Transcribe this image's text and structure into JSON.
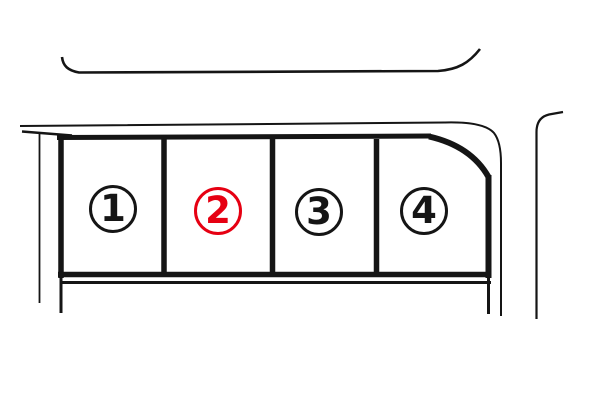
{
  "diagram": {
    "type": "lot-map",
    "background": "#ffffff",
    "line_color": "#151515",
    "highlight_color": "#e60012"
  },
  "lots": [
    {
      "label": "1",
      "color": "#151515",
      "highlighted": false
    },
    {
      "label": "2",
      "color": "#e60012",
      "highlighted": true
    },
    {
      "label": "3",
      "color": "#151515",
      "highlighted": false
    },
    {
      "label": "4",
      "color": "#151515",
      "highlighted": false
    }
  ]
}
